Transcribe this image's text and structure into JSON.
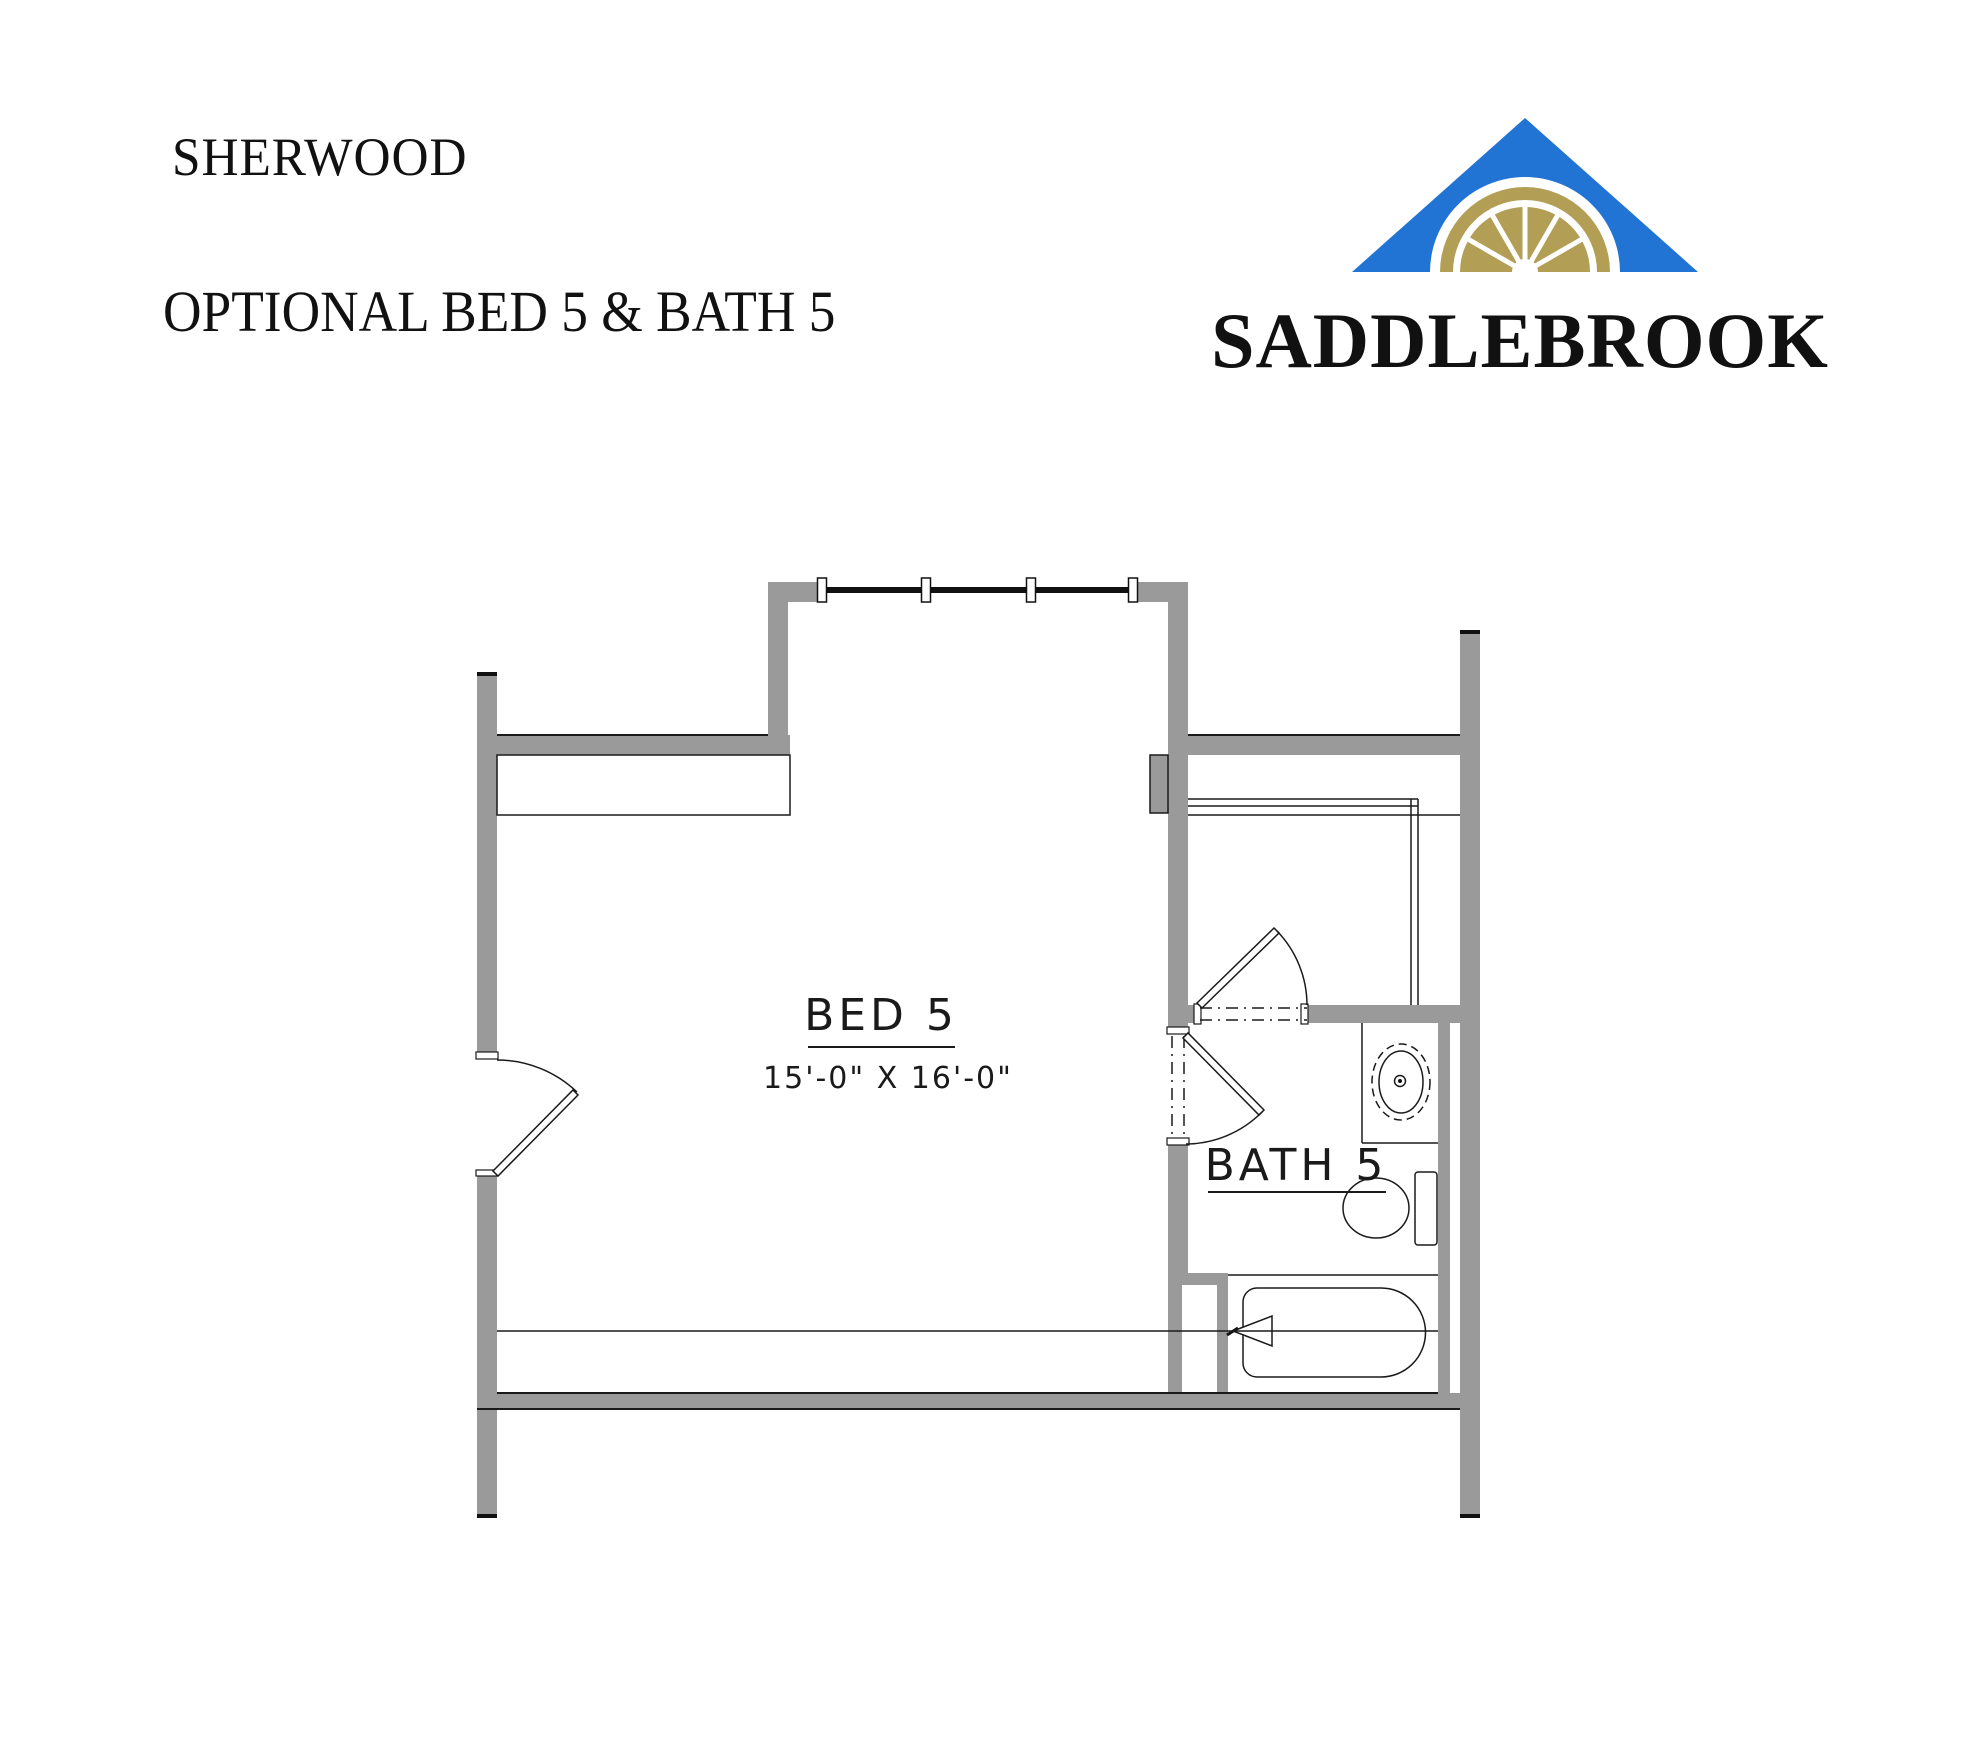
{
  "header": {
    "plan_name": "SHERWOOD",
    "subtitle": "OPTIONAL BED 5 & BATH 5"
  },
  "logo": {
    "brand": "SADDLEBROOK",
    "colors": {
      "roof_blue": "#2173d4",
      "fan_gold": "#b29f55",
      "text": "#111111"
    }
  },
  "plan": {
    "wall_color": "#9a9a9a",
    "line_color": "#1a1a1a",
    "rooms": {
      "bed5": {
        "label": "BED 5",
        "dimensions": "15'-0\" X 16'-0\""
      },
      "bath5": {
        "label": "BATH 5"
      }
    },
    "fixtures": [
      "bay-window",
      "bedroom-entry-door",
      "storage-shelf",
      "walk-in-closet-door",
      "closet-shelves",
      "vanity-sink",
      "toilet",
      "bathtub",
      "tub-faucet",
      "linen-chase"
    ]
  }
}
